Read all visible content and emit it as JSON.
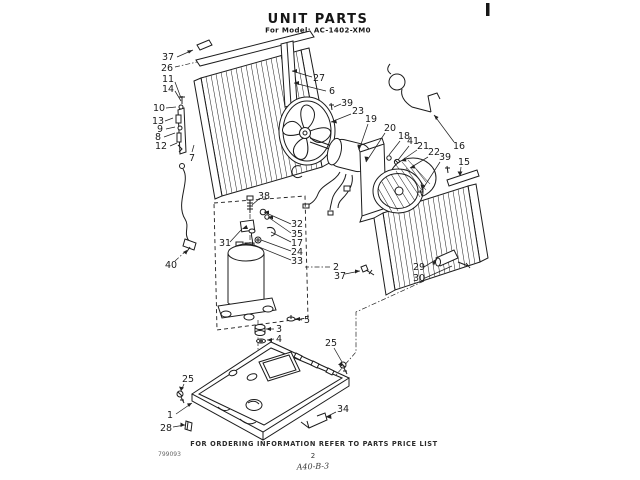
{
  "document": {
    "title": "UNIT PARTS",
    "subtitle": "For Model: AC-1402-XM0",
    "footer_note": "FOR ORDERING INFORMATION REFER TO PARTS PRICE LIST",
    "doc_number": "799093",
    "page_number": "2",
    "handwritten_ref": "A40-B-3"
  },
  "diagram": {
    "type": "exploded-parts-diagram",
    "callouts": {
      "c37a": "37",
      "c26": "26",
      "c11": "11",
      "c14": "14",
      "c10": "10",
      "c13": "13",
      "c9": "9",
      "c8": "8",
      "c12": "12",
      "c7": "7",
      "c27": "27",
      "c6": "6",
      "c39a": "39",
      "c23": "23",
      "c19": "19",
      "c20": "20",
      "c18": "18",
      "c41": "41",
      "c21": "21",
      "c22": "22",
      "c39b": "39",
      "c16": "16",
      "c15": "15",
      "c29": "29",
      "c30": "30",
      "c38": "38",
      "c31": "31",
      "c32": "32",
      "c35": "35",
      "c17": "17",
      "c24": "24",
      "c33": "33",
      "c2": "2",
      "c37b": "37",
      "c5": "5",
      "c3": "3",
      "c4": "4",
      "c25a": "25",
      "c25b": "25",
      "c1": "1",
      "c28": "28",
      "c34": "34",
      "c40": "40"
    }
  }
}
